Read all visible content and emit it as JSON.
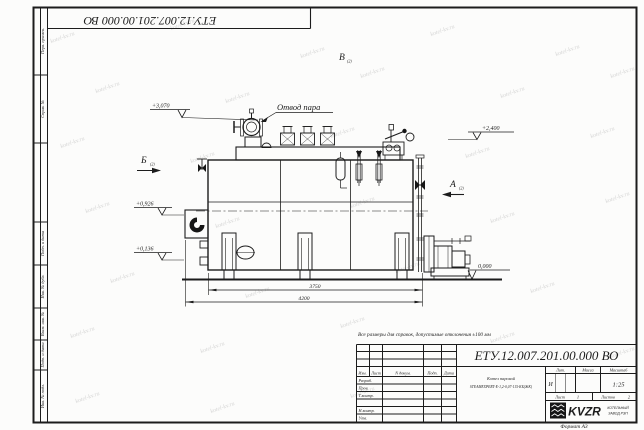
{
  "page": {
    "format": "Формат А3",
    "watermark_text": "kotel-kv.ru"
  },
  "stamp_top": "ЕТУ.12.007.201.00.000  ВО",
  "margin_labels": {
    "perv_primen": "Перв. примен.",
    "sprav_no": "Справ. №",
    "podp_data_1": "Подп. и дата",
    "inv_dubl": "Инв. № дубл.",
    "vzam_inv": "Взам. инв. №",
    "podp_data_2": "Подп. и дата",
    "inv_podl": "Инв. № подл."
  },
  "drawing": {
    "note": "Все размеры для справок, допустимые отклонения ±100 мм",
    "steam_outlet_label": "Отвод пара",
    "views": {
      "a": "А",
      "b": "Б",
      "v": "В",
      "ref": "(2)"
    },
    "elevations": {
      "e3070": "+3,070",
      "e2400": "+2,400",
      "e0926": "+0,926",
      "e0136": "+0,136",
      "e0000": "0,000"
    },
    "dims": {
      "d3750": "3750",
      "d4200": "4200"
    }
  },
  "title_block": {
    "doc_number": "ЕТУ.12.007.201.00.000  ВО",
    "change_header": [
      "Изм.",
      "Лист",
      "N докум.",
      "Подп.",
      "Дата"
    ],
    "sig_rows": [
      "Разраб.",
      "Пров.",
      "Т.контр.",
      "",
      "Н.контр.",
      "Утв."
    ],
    "name_line1": "Котел паровой",
    "name_line2": "STEAMEXPERT-E-1,2-0,07-115-КБ(ЖК)",
    "lit_label": "Лит.",
    "lit_value": "И",
    "mass_label": "Масса",
    "scale_label": "Масштаб",
    "scale_value": "1:25",
    "sheet_label": "Лист",
    "sheet_value": "1",
    "sheets_label": "Листов",
    "sheets_value": "2",
    "logo_text": "KVZR",
    "logo_line1": "КОТЕЛЬНЫЙ",
    "logo_line2": "ЗАВОД РЭП"
  }
}
